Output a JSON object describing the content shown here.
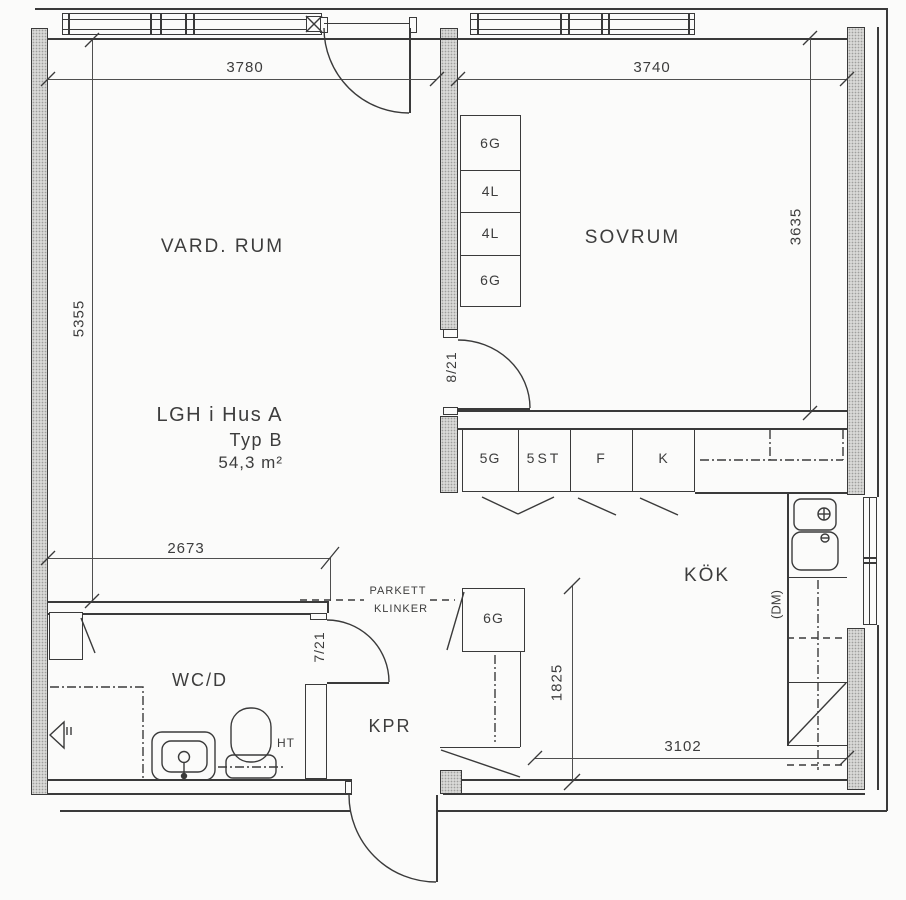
{
  "drawing": {
    "title": [
      "LGH i Hus A",
      "Typ B",
      "54,3 m²"
    ]
  },
  "rooms": {
    "living": "VARD. RUM",
    "bedroom": "SOVRUM",
    "kitchen": "KÖK",
    "bath": "WC/D",
    "hall": "KPR"
  },
  "dims": {
    "d3780": "3780",
    "d3740": "3740",
    "d5355": "5355",
    "d3635": "3635",
    "d2673": "2673",
    "d1825": "1825",
    "d3102": "3102"
  },
  "doors": {
    "bedroom": "8/21",
    "bath": "7/21"
  },
  "cabinets": {
    "wardrobe": [
      "6G",
      "4L",
      "4L",
      "6G"
    ],
    "kitchen": [
      "5G",
      "5ST",
      "F",
      "K"
    ],
    "hall": "6G"
  },
  "labels": {
    "parquet": "PARKETT",
    "tile": "KLINKER",
    "towel": "HT",
    "dishwasher": "(DM)"
  },
  "colors": {
    "line": "#3a3a3a",
    "wall": "#d8d8d6",
    "bg": "#fbfbfa"
  }
}
